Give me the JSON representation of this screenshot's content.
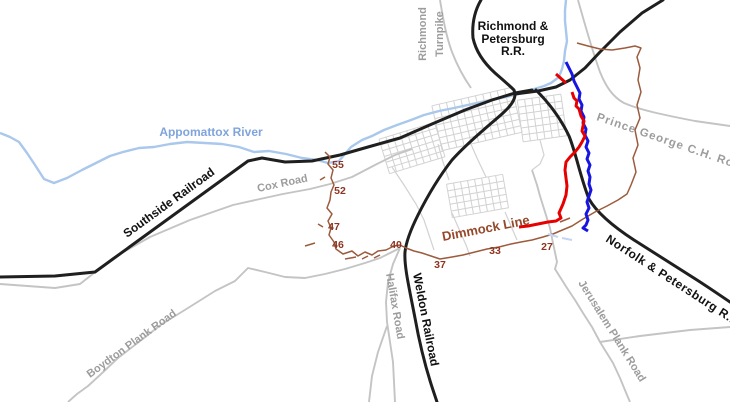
{
  "map": {
    "kind": "historical-map",
    "subject": "Petersburg Virginia railroads and Dimmock Line"
  },
  "labels": {
    "richmond_petersburg_rr": [
      "Richmond &",
      "Petersburg",
      "R.R."
    ],
    "richmond_turnpike": [
      "Richmond",
      "Turnpike"
    ],
    "appomattox_river": "Appomattox River",
    "southside_railroad": "Southside Railroad",
    "cox_road": "Cox Road",
    "prince_george_ch_road": "Prince George C.H. Road",
    "norfolk_petersburg_rr": "Norfolk & Petersburg R.R.",
    "dimmock_line": "Dimmock Line",
    "weldon_railroad": "Weldon Railroad",
    "halifax_road": "Halifax Road",
    "jerusalem_plank_road": "Jerusalem Plank Road",
    "boydton_plank_road": "Boydton Plank Road"
  },
  "battery_numbers": [
    {
      "value": "55",
      "x": 338,
      "y": 168
    },
    {
      "value": "52",
      "x": 340,
      "y": 194
    },
    {
      "value": "47",
      "x": 334,
      "y": 230
    },
    {
      "value": "46",
      "x": 338,
      "y": 248
    },
    {
      "value": "40",
      "x": 396,
      "y": 248
    },
    {
      "value": "37",
      "x": 440,
      "y": 268
    },
    {
      "value": "33",
      "x": 495,
      "y": 254
    },
    {
      "value": "27",
      "x": 547,
      "y": 250
    }
  ],
  "colors": {
    "railroad": "#1f1f1f",
    "road": "#c4c4c4",
    "city_street": "#d2d2d2",
    "river": "#a9c8ec",
    "river_label": "#7fa5dc",
    "dimmock_line_brown": "#9c5b3c",
    "battery_number": "#8e3420",
    "confederate_red": "#e60000",
    "union_blue": "#1616e0",
    "road_label_gray": "#9c9c9c"
  }
}
